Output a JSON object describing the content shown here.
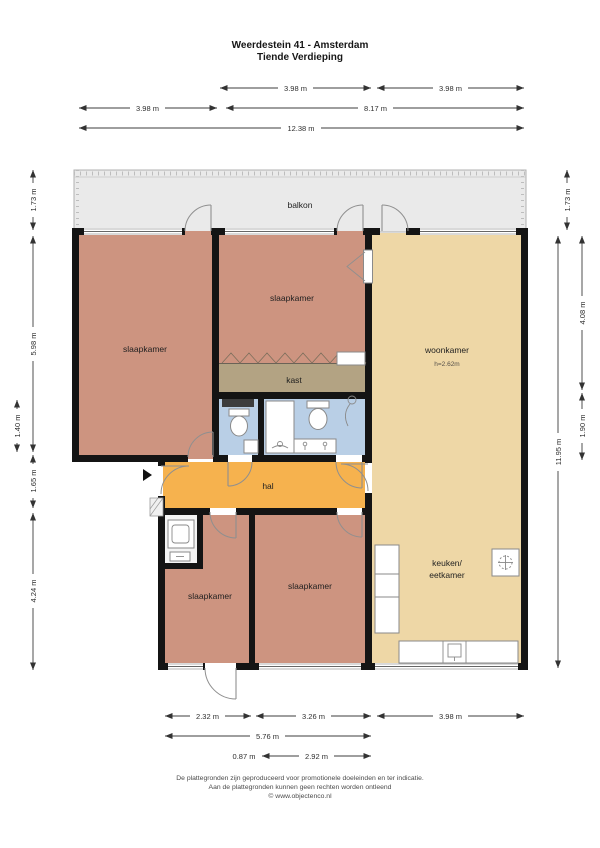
{
  "title": {
    "line1": "Weerdestein 41 - Amsterdam",
    "line2": "Tiende Verdieping"
  },
  "rooms": {
    "balcony": "balkon",
    "bedroom_top_left": "slaapkamer",
    "bedroom_top_middle": "slaapkamer",
    "living": "woonkamer",
    "living_ceiling_height": "h=2.62m",
    "closet": "kast",
    "hall": "hal",
    "bedroom_bottom_left": "slaapkamer",
    "bedroom_bottom_right": "slaapkamer",
    "kitchen_line1": "keuken/",
    "kitchen_line2": "eetkamer"
  },
  "dimensions": {
    "top_row1": [
      "3.98 m",
      "3.98 m"
    ],
    "top_row2": [
      "3.98 m",
      "8.17 m"
    ],
    "top_row3": [
      "12.38 m"
    ],
    "left": [
      "1.73 m",
      "5.98 m",
      "1.40 m",
      "1.65 m",
      "4.24 m"
    ],
    "right": [
      "1.73 m",
      "11.95 m",
      "4.08 m",
      "1.90 m"
    ],
    "bottom_row1": [
      "2.32 m",
      "3.26 m",
      "3.98 m"
    ],
    "bottom_row2": [
      "5.76 m"
    ],
    "bottom_row3": [
      "0.87 m",
      "2.92 m"
    ]
  },
  "footer": {
    "line1": "De plattegronden zijn geproduceerd voor promotionele doeleinden en ter indicatie.",
    "line2": "Aan de plattegronden kunnen geen rechten worden ontleend",
    "line3": "© www.objectenco.nl"
  },
  "colors": {
    "bedroom": "#cd9480",
    "living": "#eed7a6",
    "hall": "#f6b24e",
    "closet": "#b3a383",
    "bathroom": "#b9cfe6",
    "balcony": "#eaeaea",
    "wall": "#141414"
  },
  "icons": {
    "entrance-arrow": "▶",
    "ventilation": "✳"
  }
}
